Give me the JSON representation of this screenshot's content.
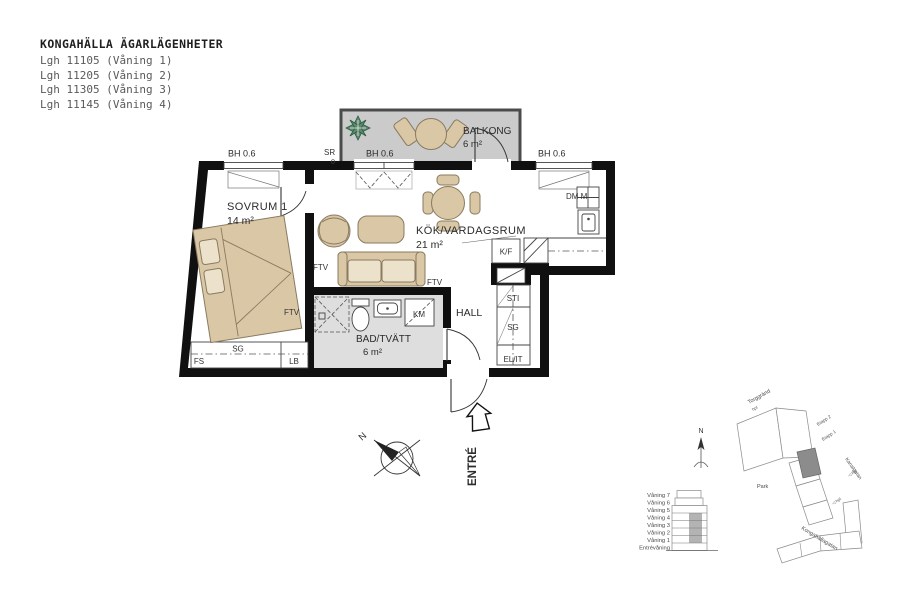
{
  "header": {
    "title": "KONGAHÄLLA ÄGARLÄGENHETER",
    "apartments": [
      "Lgh 11105 (Våning 1)",
      "Lgh 11205 (Våning 2)",
      "Lgh 11305 (Våning 3)",
      "Lgh 11145 (Våning 4)"
    ]
  },
  "plan": {
    "rooms": {
      "sovrum": {
        "name": "SOVRUM 1",
        "area": "14 m²"
      },
      "kok": {
        "name": "KÖK/VARDAGSRUM",
        "area": "21 m²"
      },
      "bad": {
        "name": "BAD/TVÄTT",
        "area": "6 m²"
      },
      "balkong": {
        "name": "BALKONG",
        "area": "6 m²"
      },
      "hall": {
        "name": "HALL"
      }
    },
    "labels": {
      "window_height": "BH 0.6",
      "sr": "SR",
      "ftv": "FTV",
      "kf": "K/F",
      "dm": "DM M",
      "km": "KM",
      "sti": "STI",
      "sg": "SG",
      "el_it": "EL/IT",
      "fs": "FS",
      "lb": "LB",
      "entre": "ENTRÉ",
      "north": "N"
    }
  },
  "site": {
    "north": "N",
    "floors": [
      "Våning 7",
      "Våning 6",
      "Våning 5",
      "Våning 4",
      "Våning 3",
      "Våning 2",
      "Våning 1",
      "Entrévåning"
    ],
    "labels": {
      "torggrand": "Torggränd",
      "hpl": "hpl",
      "hpl_marker": "◁ hpl",
      "etapp2": "Etapp 2",
      "etapp1": "Etapp 1",
      "street_right": "Kanalgatan",
      "park": "Park",
      "street_bottom": "Kongahällagatan"
    }
  },
  "colors": {
    "wall": "#101010",
    "furniture": "#d9c7a6",
    "furniture_light": "#ece2cb",
    "balcony_floor": "#cbcbcb",
    "bath_floor": "#dedede",
    "plant": "#5d8a6e",
    "unit_highlight": "#8c8c8c",
    "floors_highlight": "#b3b3b3"
  }
}
